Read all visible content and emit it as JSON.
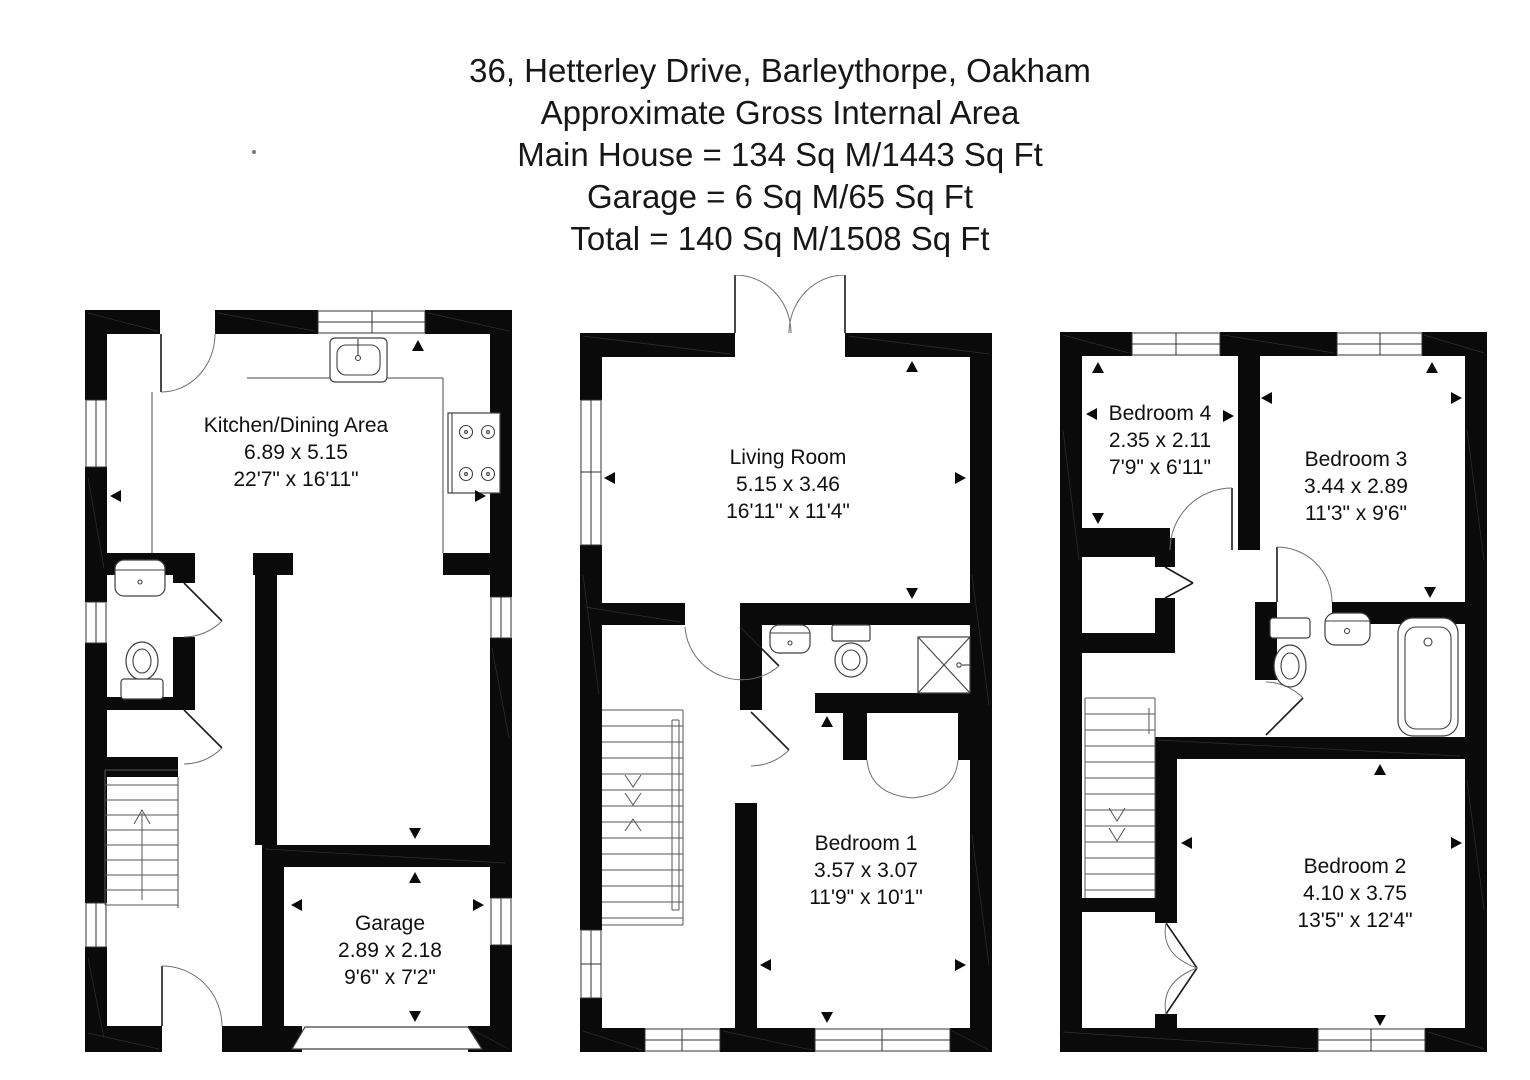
{
  "title": {
    "address": "36, Hetterley Drive, Barleythorpe, Oakham",
    "area_heading": "Approximate Gross Internal Area",
    "main_house": "Main House = 134 Sq M/1443 Sq Ft",
    "garage_line": "Garage = 6 Sq M/65 Sq Ft",
    "total_line": "Total = 140 Sq M/1508 Sq Ft"
  },
  "rooms": {
    "kitchen_dining": {
      "name": "Kitchen/Dining Area",
      "metric": "6.89 x 5.15",
      "imperial": "22'7\" x 16'11\""
    },
    "garage": {
      "name": "Garage",
      "metric": "2.89 x 2.18",
      "imperial": "9'6\" x 7'2\""
    },
    "living_room": {
      "name": "Living Room",
      "metric": "5.15 x 3.46",
      "imperial": "16'11\" x 11'4\""
    },
    "bedroom1": {
      "name": "Bedroom 1",
      "metric": "3.57 x 3.07",
      "imperial": "11'9\" x 10'1\""
    },
    "bedroom2": {
      "name": "Bedroom 2",
      "metric": "4.10 x 3.75",
      "imperial": "13'5\" x 12'4\""
    },
    "bedroom3": {
      "name": "Bedroom 3",
      "metric": "3.44 x 2.89",
      "imperial": "11'3\" x 9'6\""
    },
    "bedroom4": {
      "name": "Bedroom 4",
      "metric": "2.35 x 2.11",
      "imperial": "7'9\" x 6'11\""
    }
  }
}
